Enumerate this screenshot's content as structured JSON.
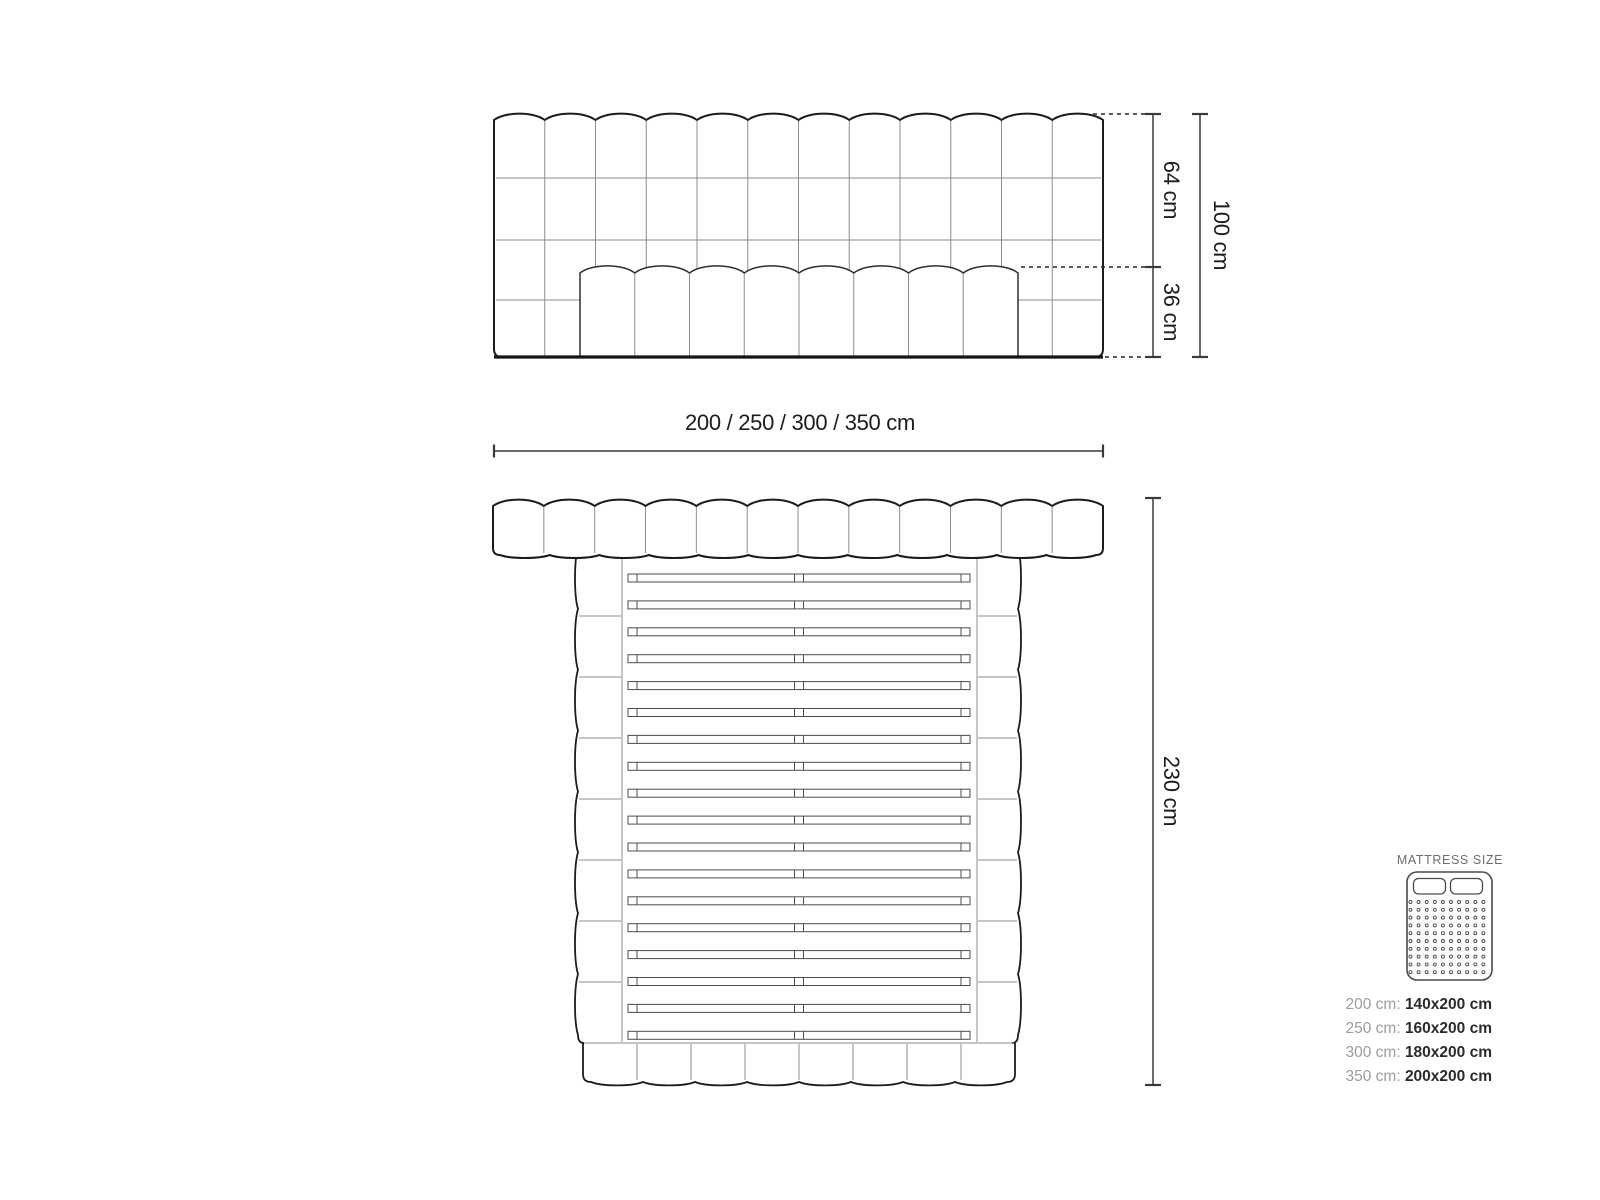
{
  "labels": {
    "width": "200 / 250 / 300 / 350 cm",
    "upper": "64 cm",
    "lower": "36 cm",
    "total": "100 cm",
    "length": "230 cm"
  },
  "panel": {
    "title": "MATTRESS SIZE",
    "rows": [
      {
        "size": "200 cm:",
        "dims": "140x200 cm"
      },
      {
        "size": "250 cm:",
        "dims": "160x200 cm"
      },
      {
        "size": "300 cm:",
        "dims": "180x200 cm"
      },
      {
        "size": "350 cm:",
        "dims": "200x200 cm"
      }
    ]
  },
  "structure": {
    "front_columns": 12,
    "front_rows": 4,
    "front_mattress_segments": 8,
    "plan_headboard_segments": 12,
    "plan_rail_segments": 8,
    "plan_footboard_segments": 8,
    "slat_count": 18,
    "dot_grid": 10
  },
  "colors": {
    "outline": "#1c1c1c",
    "heavy": "#141414",
    "seam": "#8c8c8c",
    "slat": "#4d4d4d",
    "dim": "#3a3a3a",
    "dash": "#262626",
    "icon": "#4a4a4a"
  }
}
